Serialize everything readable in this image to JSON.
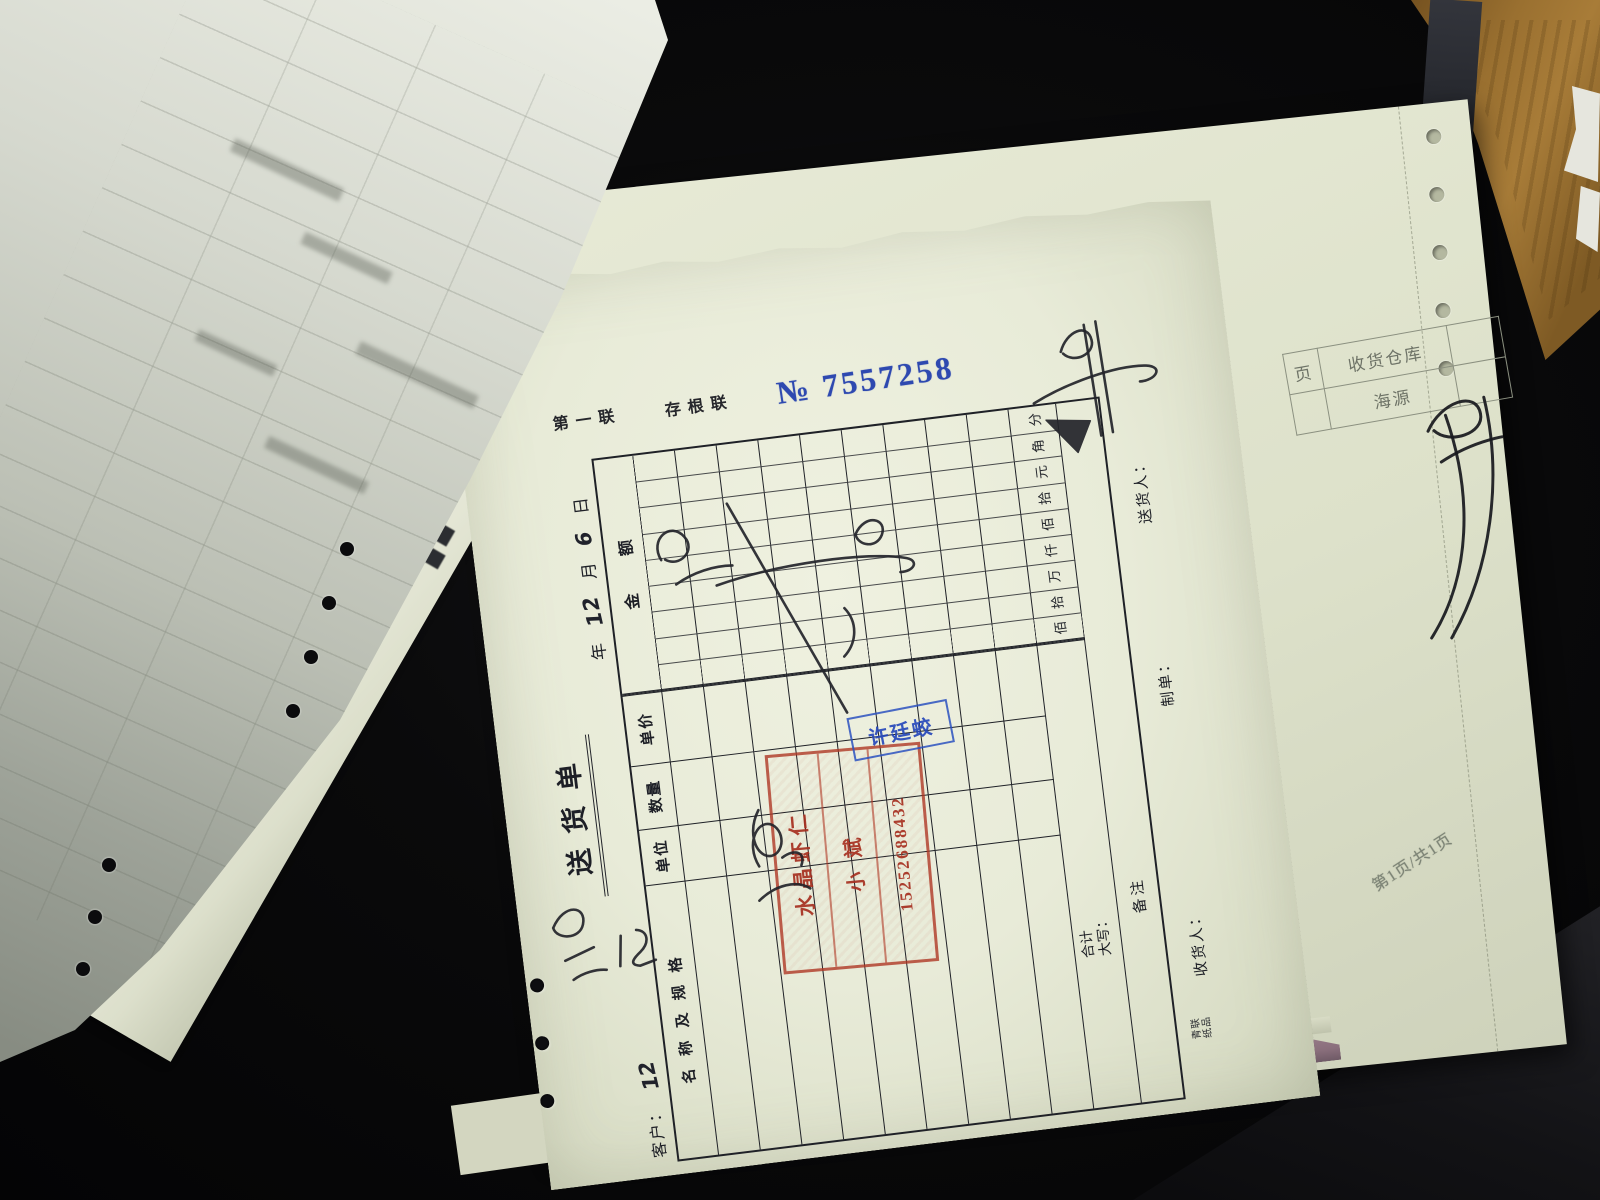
{
  "main_form": {
    "copy_labels": {
      "part": "第一联",
      "type": "存根联"
    },
    "serial": {
      "prefix": "№",
      "number": "7557258"
    },
    "title": "送货单",
    "customer_label": "客户：",
    "customer_handwriting": "12",
    "date": {
      "year_label": "年",
      "month_value": "12",
      "month_label": "月",
      "day_value": "6",
      "day_label": "日"
    },
    "table": {
      "headers": [
        "名称及规格",
        "单位",
        "数量",
        "单价",
        "金额"
      ],
      "amount_digit_labels": [
        "佰",
        "拾",
        "万",
        "仟",
        "佰",
        "拾",
        "元",
        "角",
        "分"
      ],
      "item_row_count": 9,
      "total_label_line1": "合计",
      "total_label_line2": "大写：",
      "remark_label": "备注"
    },
    "footer": {
      "receiver_label": "收货人：",
      "maker_label": "制单：",
      "deliverer_label": "送货人："
    },
    "brand": {
      "line1": "青联",
      "line2": "纸品"
    },
    "red_stamp": {
      "line1": "水晶虾仁",
      "line2": "小斌",
      "line3": "15252688432"
    },
    "blue_stamp": {
      "name": "许廷蛟"
    }
  },
  "under_sheet": {
    "page_cell_label": "页",
    "warehouse_label": "收货仓库",
    "warehouse_value": "海源",
    "page_indicator": "第1页/共1页"
  },
  "colors": {
    "serial_blue": "#2e49b0",
    "stamp_red": "#b23420",
    "stamp_blue": "#2b51c0",
    "paper": "#edf0de",
    "ink": "#1d1f26"
  }
}
